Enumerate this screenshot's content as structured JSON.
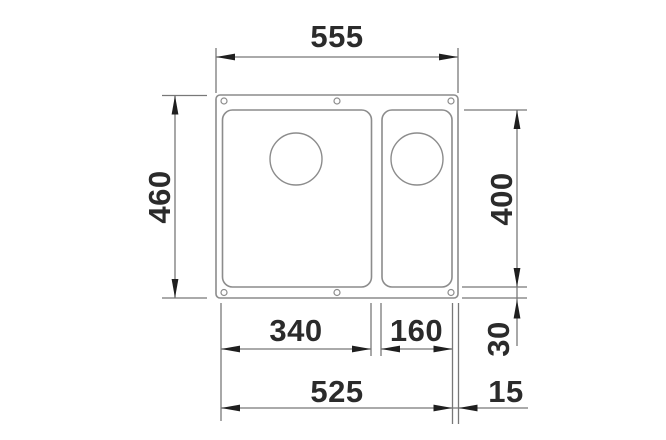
{
  "diagram": {
    "subject": "undermount-double-bowl-sink-top-view-dimension-drawing",
    "dimensions": {
      "overall_width": "555",
      "overall_depth": "460",
      "bowl_length": "400",
      "main_bowl_width": "340",
      "small_bowl_width": "160",
      "edge_offset_vertical": "30",
      "bowls_total_width": "525",
      "edge_offset_horizontal": "15"
    },
    "colors": {
      "background": "#ffffff",
      "drawing_line": "#8c8c8c",
      "dimension_line": "#787878",
      "arrow": "#1f1f1f",
      "text": "#2b2b2b"
    }
  }
}
